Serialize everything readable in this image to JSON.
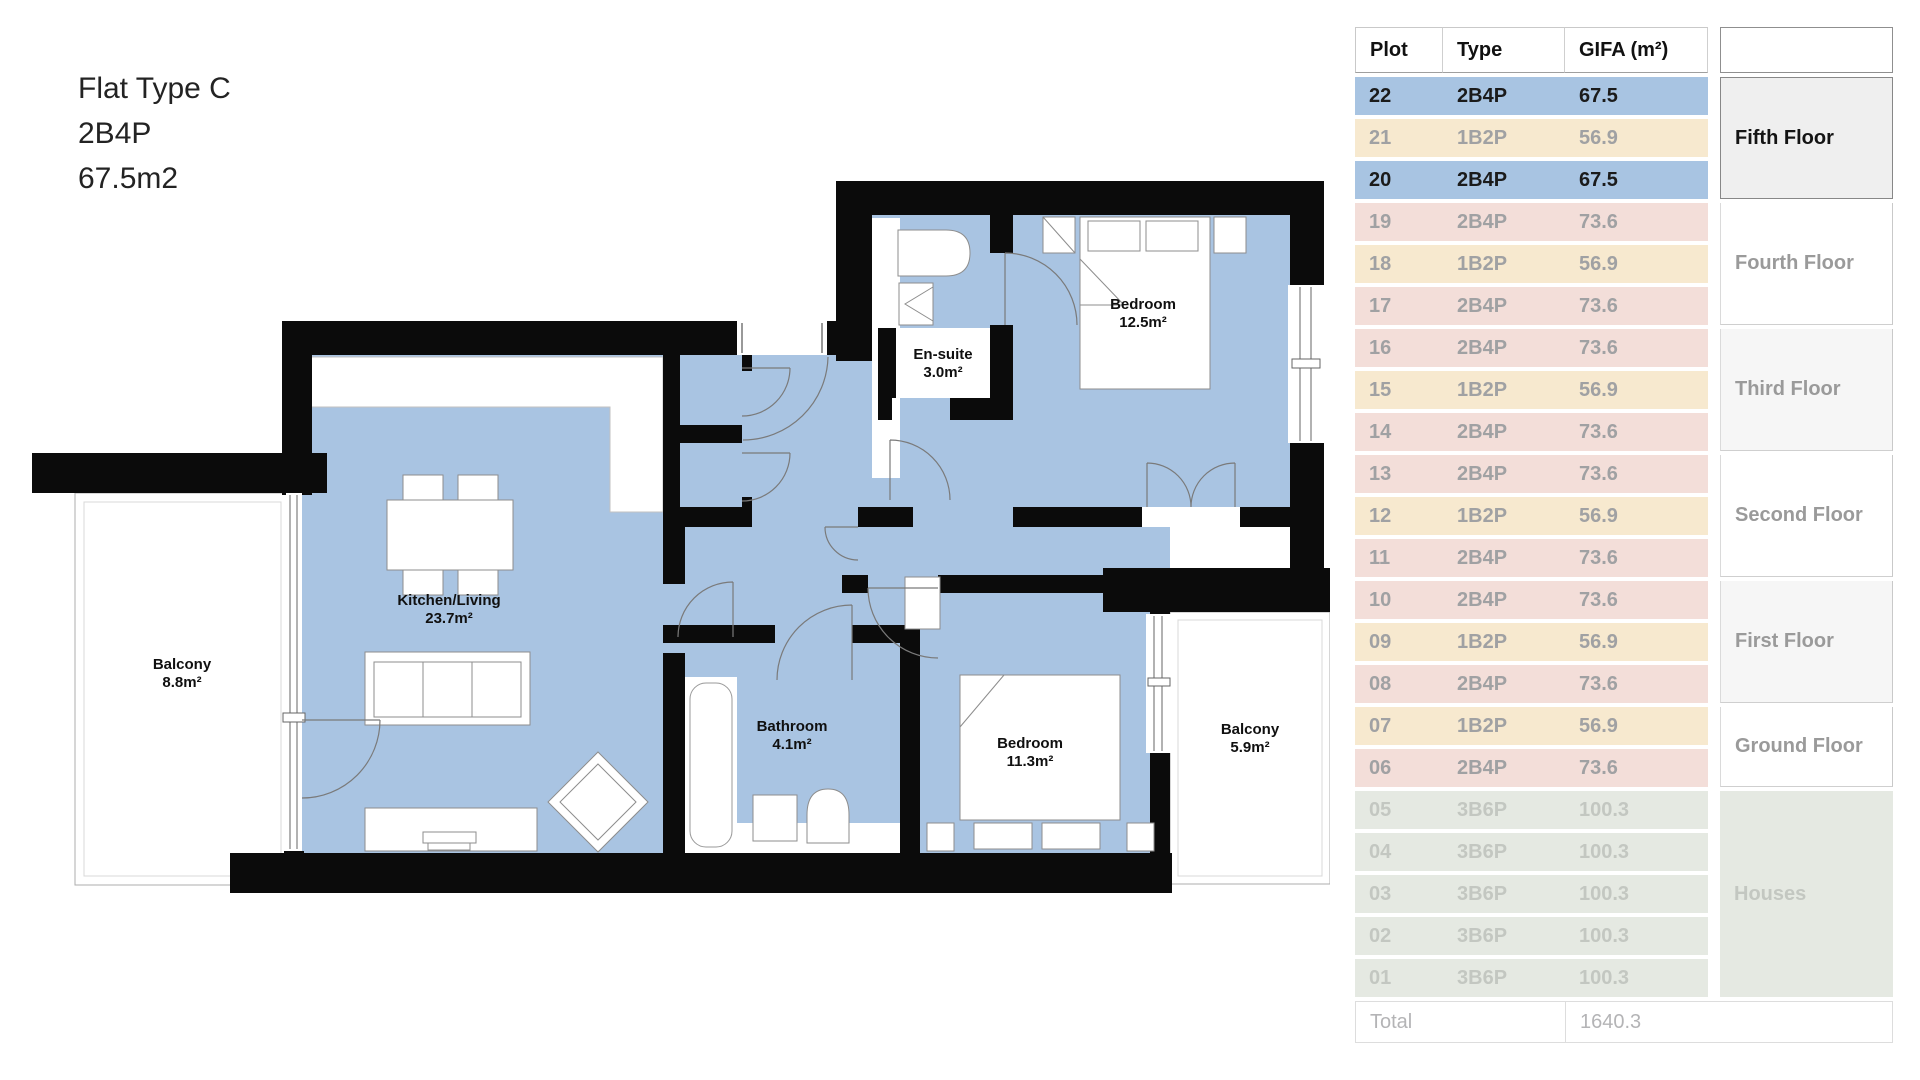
{
  "title": {
    "name": "Flat Type C",
    "type": "2B4P",
    "area": "67.5m2"
  },
  "floorplan": {
    "rooms": [
      {
        "name": "Balcony",
        "area": "8.8m²"
      },
      {
        "name": "Kitchen/Living",
        "area": "23.7m²"
      },
      {
        "name": "Bathroom",
        "area": "4.1m²"
      },
      {
        "name": "Bedroom",
        "area": "11.3m²"
      },
      {
        "name": "Balcony",
        "area": "5.9m²"
      },
      {
        "name": "En-suite",
        "area": "3.0m²"
      },
      {
        "name": "Bedroom",
        "area": "12.5m²"
      }
    ]
  },
  "table": {
    "headers": {
      "plot": "Plot",
      "type": "Type",
      "gifa": "GIFA (m²)"
    },
    "floors": [
      {
        "label": "Fifth Floor"
      },
      {
        "label": "Fourth Floor"
      },
      {
        "label": "Third Floor"
      },
      {
        "label": "Second Floor"
      },
      {
        "label": "First Floor"
      },
      {
        "label": "Ground Floor"
      },
      {
        "label": "Houses"
      }
    ],
    "rows": [
      {
        "plot": "22",
        "type": "2B4P",
        "gifa": "67.5"
      },
      {
        "plot": "21",
        "type": "1B2P",
        "gifa": "56.9"
      },
      {
        "plot": "20",
        "type": "2B4P",
        "gifa": "67.5"
      },
      {
        "plot": "19",
        "type": "2B4P",
        "gifa": "73.6"
      },
      {
        "plot": "18",
        "type": "1B2P",
        "gifa": "56.9"
      },
      {
        "plot": "17",
        "type": "2B4P",
        "gifa": "73.6"
      },
      {
        "plot": "16",
        "type": "2B4P",
        "gifa": "73.6"
      },
      {
        "plot": "15",
        "type": "1B2P",
        "gifa": "56.9"
      },
      {
        "plot": "14",
        "type": "2B4P",
        "gifa": "73.6"
      },
      {
        "plot": "13",
        "type": "2B4P",
        "gifa": "73.6"
      },
      {
        "plot": "12",
        "type": "1B2P",
        "gifa": "56.9"
      },
      {
        "plot": "11",
        "type": "2B4P",
        "gifa": "73.6"
      },
      {
        "plot": "10",
        "type": "2B4P",
        "gifa": "73.6"
      },
      {
        "plot": "09",
        "type": "1B2P",
        "gifa": "56.9"
      },
      {
        "plot": "08",
        "type": "2B4P",
        "gifa": "73.6"
      },
      {
        "plot": "07",
        "type": "1B2P",
        "gifa": "56.9"
      },
      {
        "plot": "06",
        "type": "2B4P",
        "gifa": "73.6"
      },
      {
        "plot": "05",
        "type": "3B6P",
        "gifa": "100.3"
      },
      {
        "plot": "04",
        "type": "3B6P",
        "gifa": "100.3"
      },
      {
        "plot": "03",
        "type": "3B6P",
        "gifa": "100.3"
      },
      {
        "plot": "02",
        "type": "3B6P",
        "gifa": "100.3"
      },
      {
        "plot": "01",
        "type": "3B6P",
        "gifa": "100.3"
      }
    ],
    "total_label": "Total",
    "total_value": "1640.3"
  },
  "colors": {
    "row_blue": "#a8c4e2",
    "row_cream": "#f7e9cf",
    "row_pink": "#f3ded9",
    "row_green": "#e5e9e2",
    "floor_selected_bg": "#efefef",
    "floor_gray_bg": "#f6f6f6",
    "plan_floor": "#a9c4e2",
    "plan_wall": "#0b0b0b",
    "text_dark": "#1b1b1b",
    "text_dim": "#a0a1a3",
    "text_faint": "#c3c7c1"
  }
}
